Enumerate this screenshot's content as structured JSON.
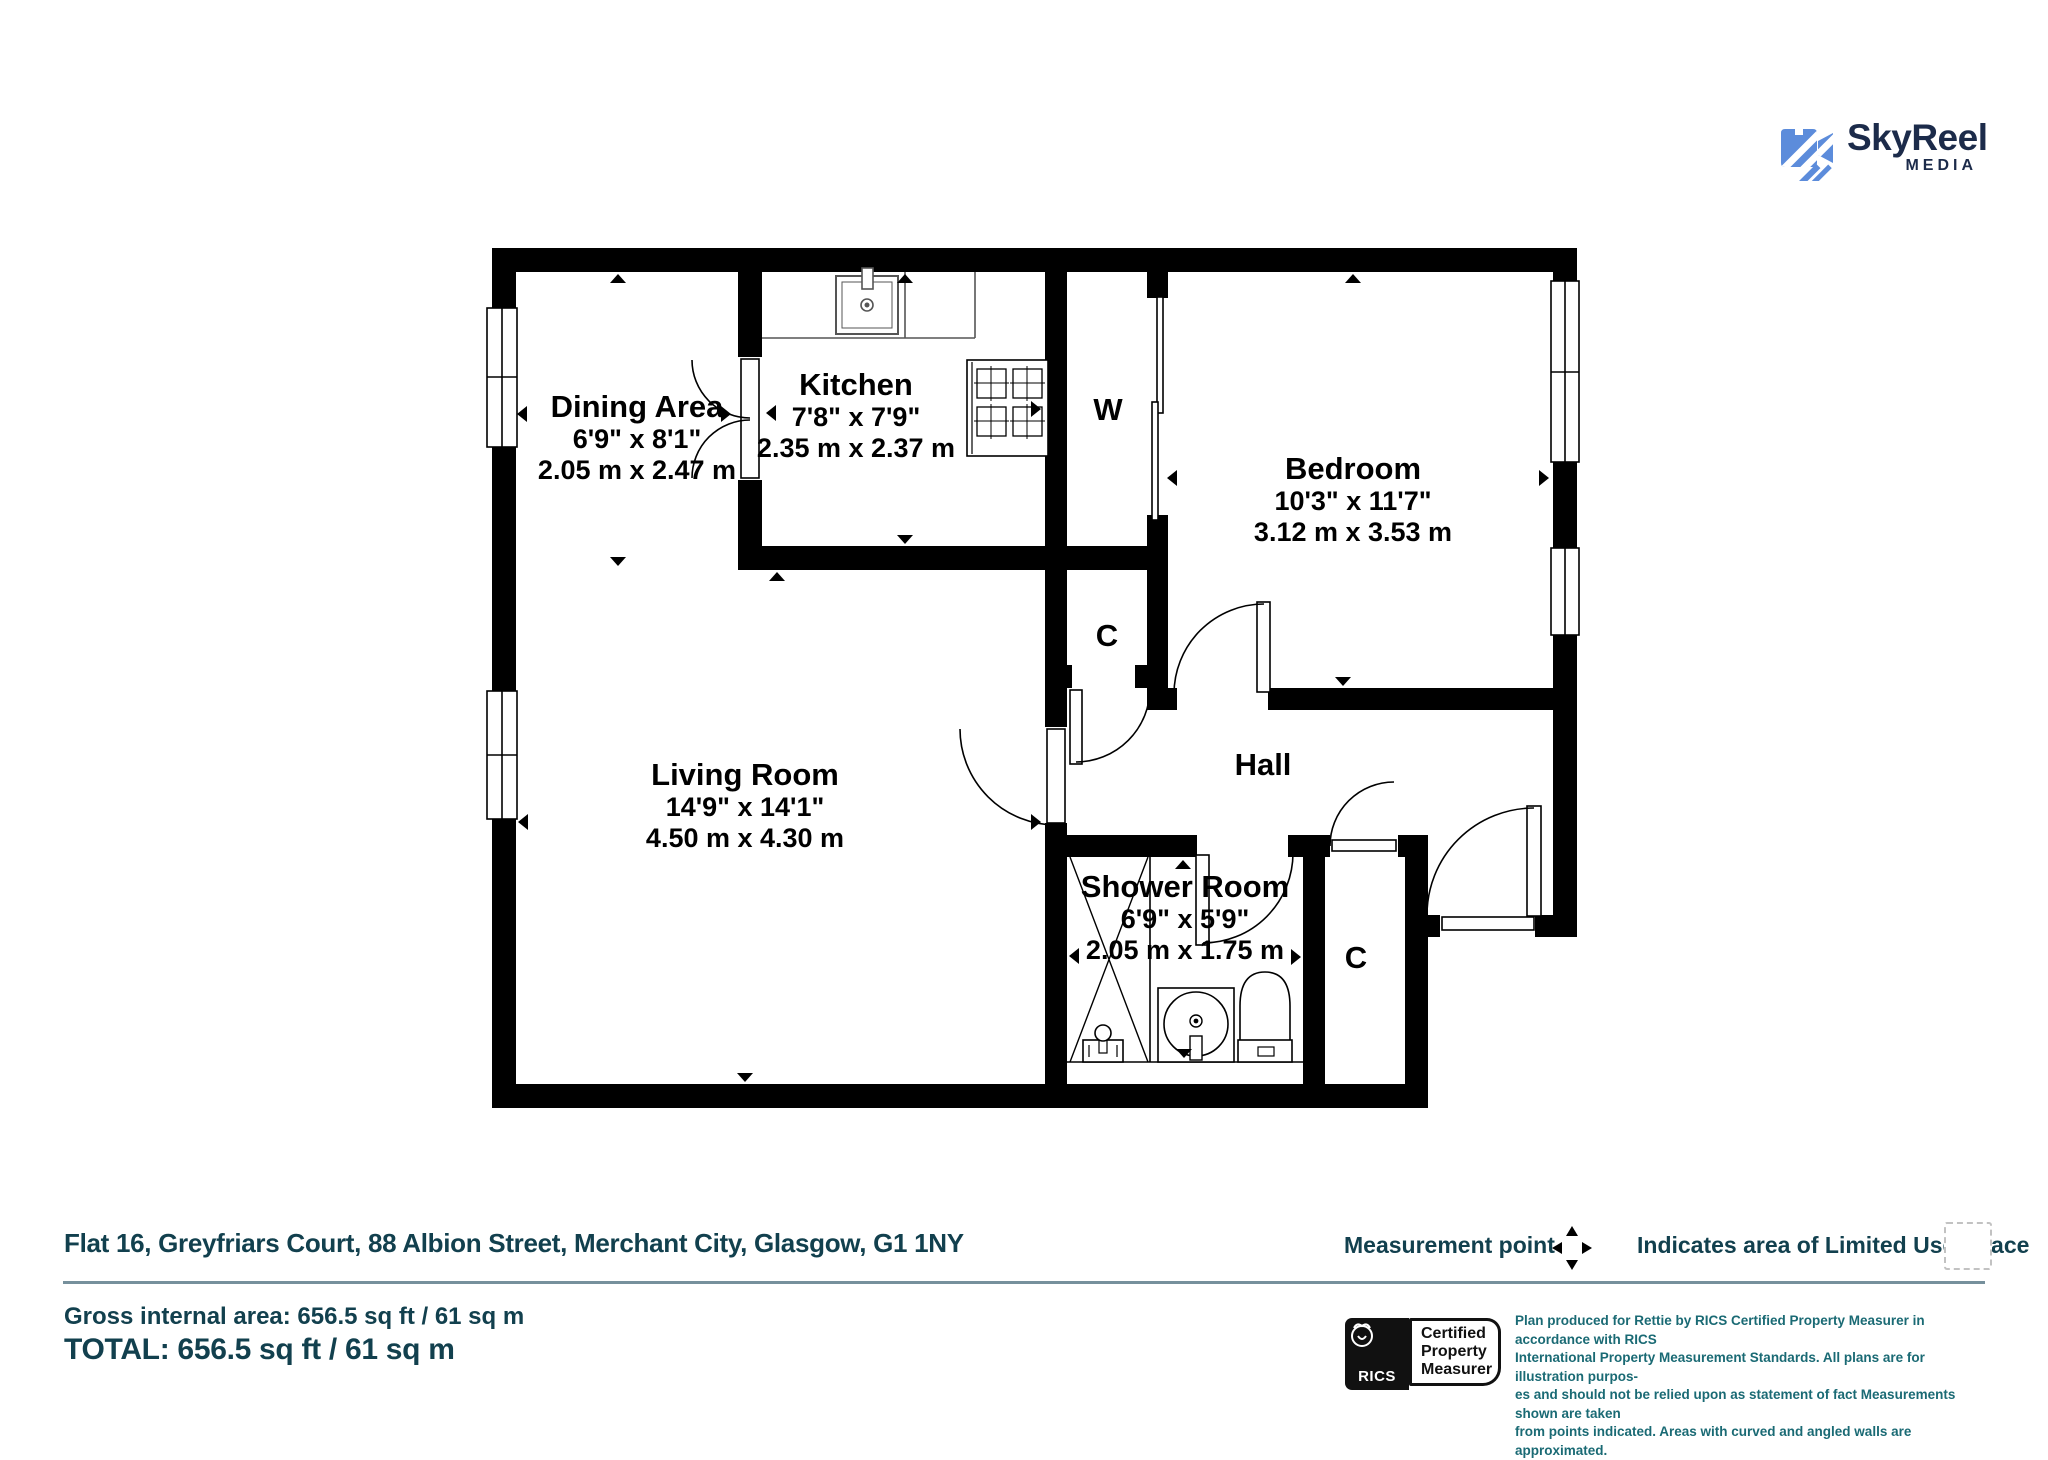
{
  "header": {
    "logo_text": "SkyReel",
    "logo_sub": "MEDIA"
  },
  "rooms": {
    "dining": {
      "name": "Dining Area",
      "imperial": "6'9\" x 8'1\"",
      "metric": "2.05 m x 2.47 m"
    },
    "kitchen": {
      "name": "Kitchen",
      "imperial": "7'8\" x 7'9\"",
      "metric": "2.35 m x 2.37 m"
    },
    "bedroom": {
      "name": "Bedroom",
      "imperial": "10'3\" x 11'7\"",
      "metric": "3.12 m x 3.53 m"
    },
    "living": {
      "name": "Living Room",
      "imperial": "14'9\" x 14'1\"",
      "metric": "4.50 m x 4.30 m"
    },
    "shower": {
      "name": "Shower Room",
      "imperial": "6'9\" x 5'9\"",
      "metric": "2.05 m x 1.75 m"
    },
    "hall": {
      "name": "Hall"
    },
    "wardrobe": {
      "name": "W"
    },
    "cupboard1": {
      "name": "C"
    },
    "cupboard2": {
      "name": "C"
    }
  },
  "footer": {
    "address": "Flat 16, Greyfriars Court, 88 Albion Street, Merchant City, Glasgow, G1 1NY",
    "measurement_point_label": "Measurement point",
    "limited_use_label": "Indicates area of  Limited Use Space",
    "gross_area": "Gross internal area: 656.5 sq ft / 61 sq m",
    "total": "TOTAL: 656.5 sq ft / 61 sq m",
    "rics": {
      "brand": "RICS",
      "line1": "Certified",
      "line2": "Property",
      "line3": "Measurer"
    },
    "disclaimer_lines": [
      "Plan produced for Rettie by RICS Certified Property Measurer in accordance with RICS",
      "International Property  Measurement Standards.  All plans are for illustration purpos-",
      "es and should not be relied upon as statement of fact Measurements shown are taken",
      "from points indicated. Areas with curved and angled walls are approximated."
    ]
  },
  "colors": {
    "accent_teal": "#12404E",
    "fine_print_teal": "#1A6A74",
    "logo_navy": "#1C2B4A",
    "logo_blue": "#5C8CDB",
    "plan_black": "#000000"
  }
}
